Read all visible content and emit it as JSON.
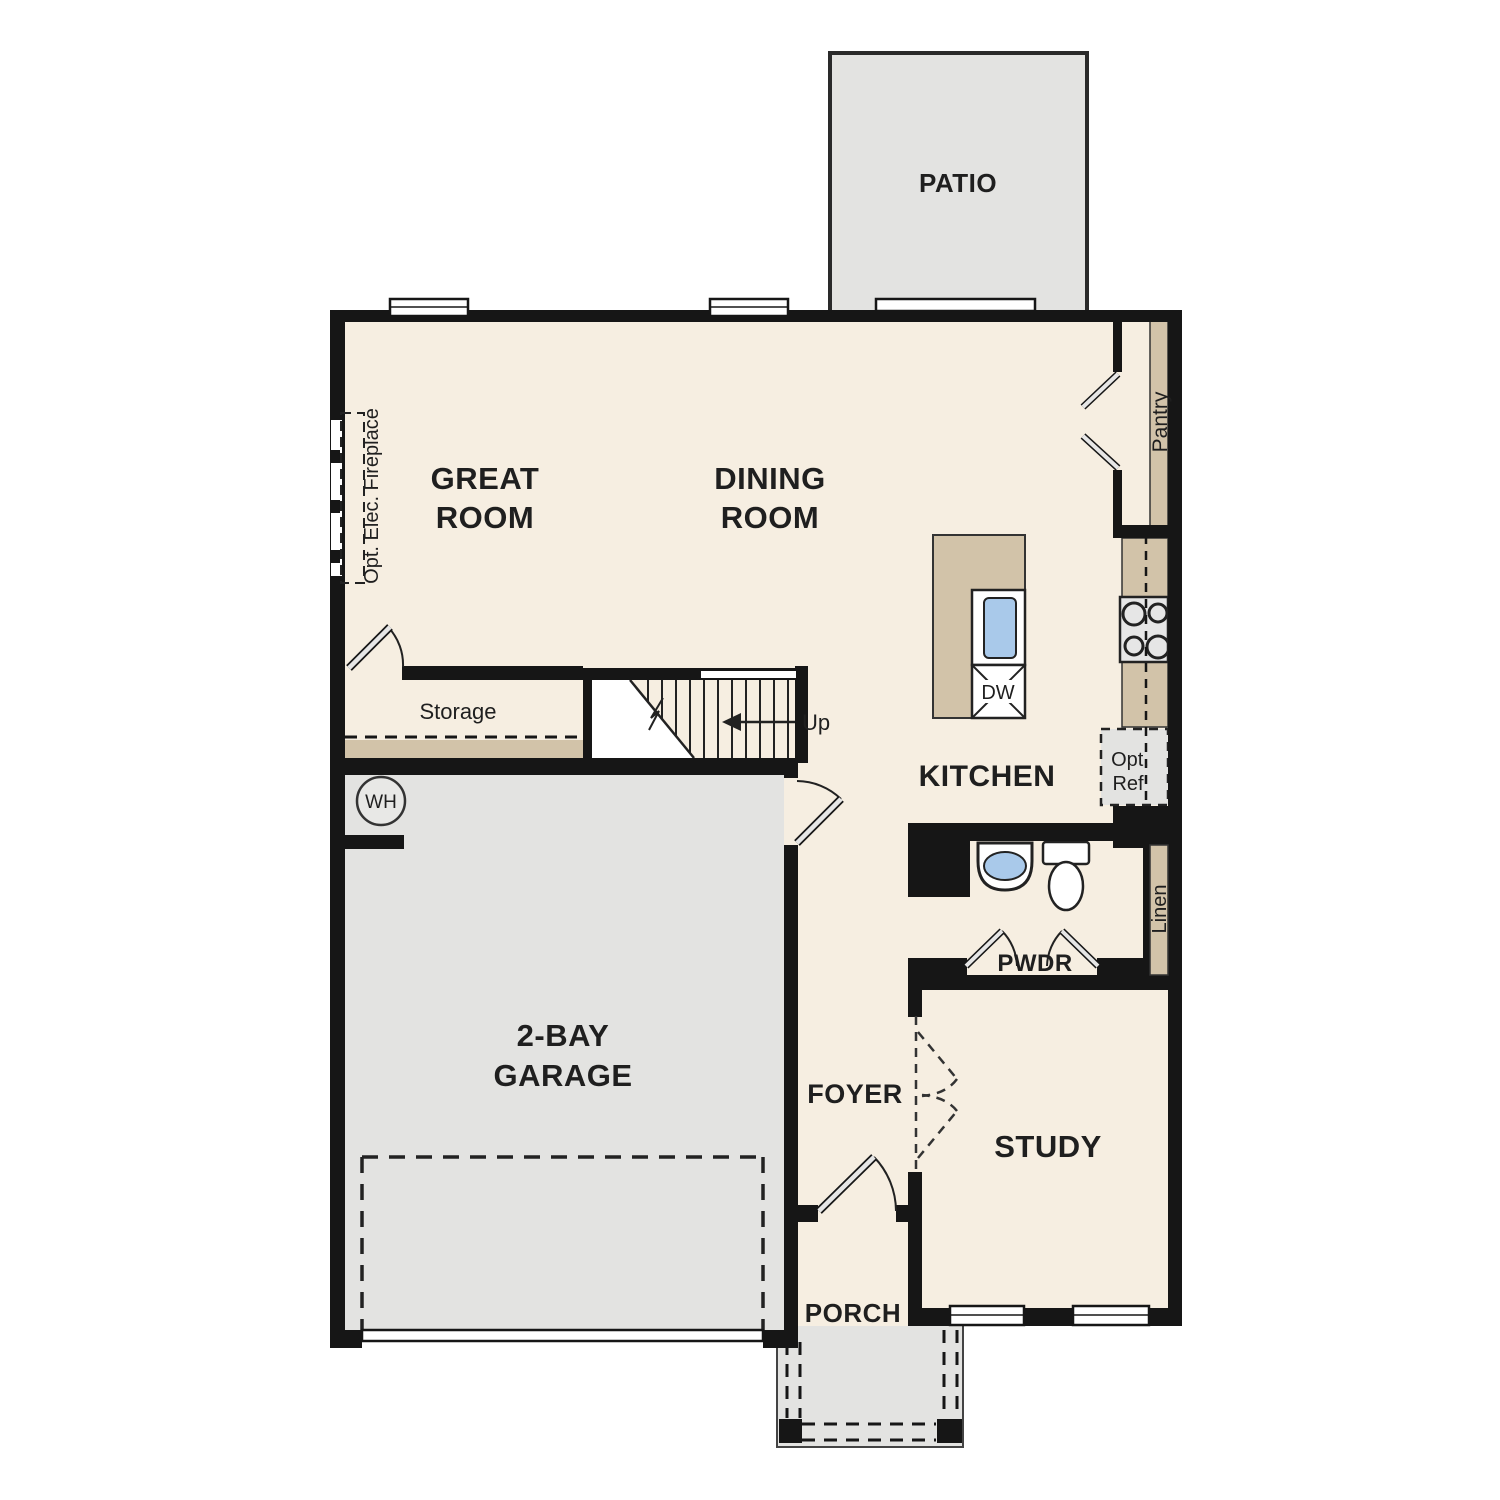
{
  "title": "First floor plan",
  "colors": {
    "floor": "#f6eee1",
    "hardscape": "#e3e3e1",
    "casework": "#d2c3a9",
    "wall": "#161616",
    "sink_blue": "#a9c9ea",
    "appliance_gray": "#e6e6e6",
    "text": "#1f1f1f"
  },
  "labels": {
    "patio": "PATIO",
    "great_room": [
      "GREAT",
      "ROOM"
    ],
    "dining_room": [
      "DINING",
      "ROOM"
    ],
    "kitchen": "KITCHEN",
    "garage": [
      "2-BAY",
      "GARAGE"
    ],
    "foyer": "FOYER",
    "study": "STUDY",
    "porch": "PORCH",
    "pwdr": "PWDR",
    "pantry": "Pantry",
    "linen": "Linen",
    "storage": "Storage",
    "up": "Up",
    "wh": "WH",
    "dw": "DW",
    "opt_ref": [
      "Opt.",
      "Ref"
    ],
    "opt_fireplace": "Opt. Elec. Fireplace"
  }
}
